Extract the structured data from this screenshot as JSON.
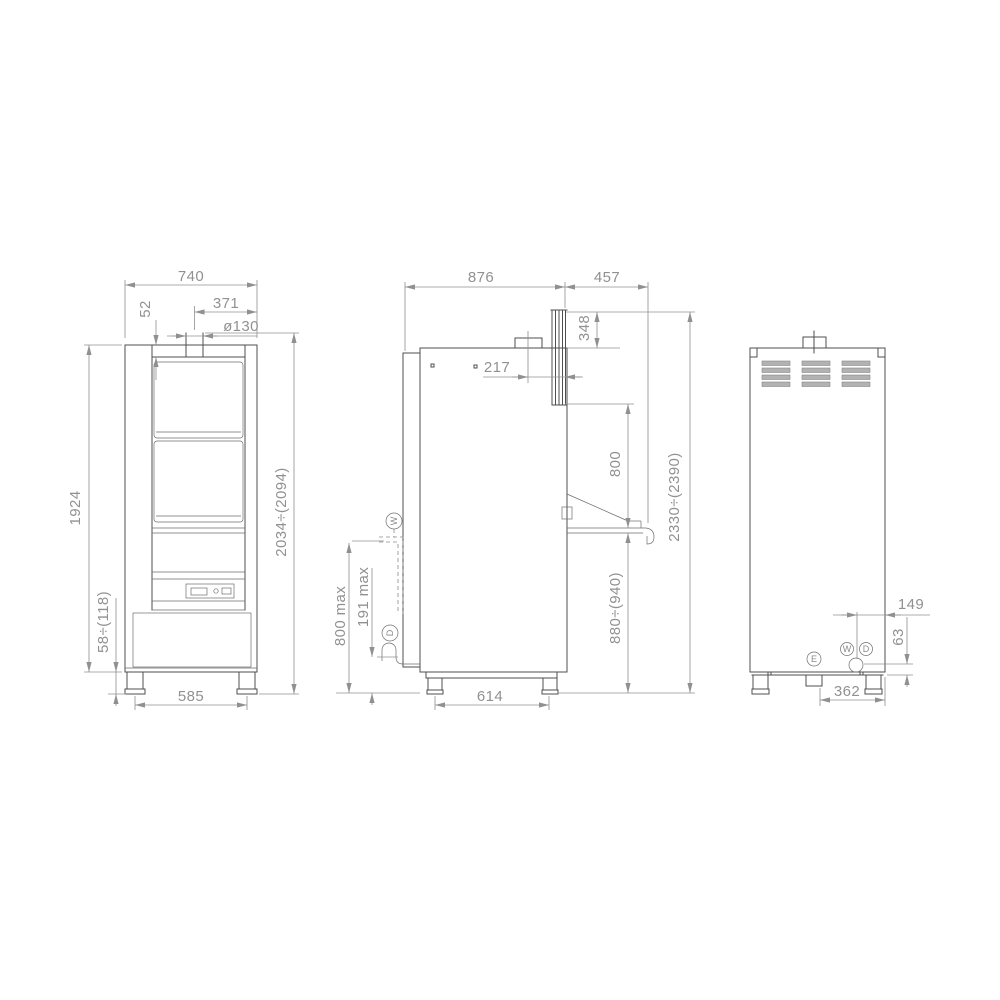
{
  "drawing": {
    "colors": {
      "geometry_line": "#4f4f4f",
      "dimension_line": "#909090",
      "louver_fill": "#b2b2b2"
    }
  },
  "views": {
    "front": {
      "name": "front view",
      "dims": {
        "overall_width": "740",
        "exhaust_offset": "371",
        "top_clearance": "52",
        "exhaust_diameter": "ø130",
        "body_height": "1924",
        "plinth_height": "58÷(118)",
        "foot_spacing": "585",
        "overall_height": "2034÷(2094)"
      }
    },
    "side": {
      "name": "side view",
      "dims": {
        "overall_depth": "876",
        "table_overhang": "457",
        "hood_travel": "348",
        "exhaust_offset": "217",
        "opening_height": "800",
        "overall_height_open": "2330÷(2390)",
        "working_height": "880÷(940)",
        "water_inlet_max": "800 max",
        "drain_outlet_max": "191 max",
        "foot_spacing": "614"
      },
      "connections": {
        "water": "W",
        "drain": "D"
      }
    },
    "rear": {
      "name": "rear view",
      "dims": {
        "drain_offset": "149",
        "drain_height": "63",
        "connection_span": "362"
      },
      "connections": {
        "electric": "E",
        "water": "W",
        "drain": "D"
      }
    }
  }
}
